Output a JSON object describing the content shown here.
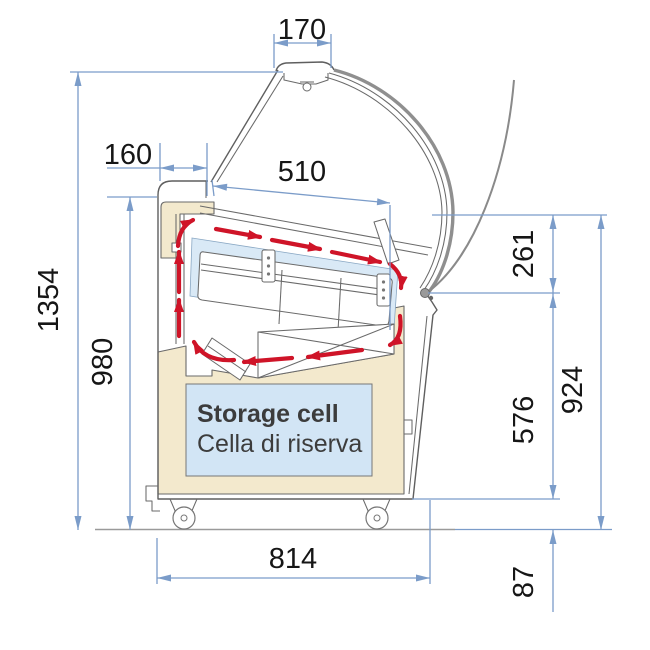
{
  "diagram": {
    "type": "technical-section-drawing",
    "subject": "ice-cream display case side section with airflow and dimensions",
    "storage": {
      "title": "Storage cell",
      "subtitle": "Cella di riserva"
    },
    "dimensions": {
      "canopy_width": "170",
      "rear_top_depth": "160",
      "display_opening_width": "510",
      "overall_height": "1354",
      "worktop_height": "980",
      "upper_front_section": "261",
      "lower_front_section": "576",
      "front_height": "924",
      "base_width": "814",
      "base_clearance": "87"
    },
    "colors": {
      "dimension_blue": "#7b9cc9",
      "airflow_red": "#cf1428",
      "insulation_cream": "#f3e9cd",
      "well_blue": "#d9e9f6",
      "storage_blue": "#d2e5f5",
      "outline_gray": "#5f5f5f",
      "floor_gray": "#9a9a9a",
      "label_dark": "#3c3c3c"
    }
  }
}
